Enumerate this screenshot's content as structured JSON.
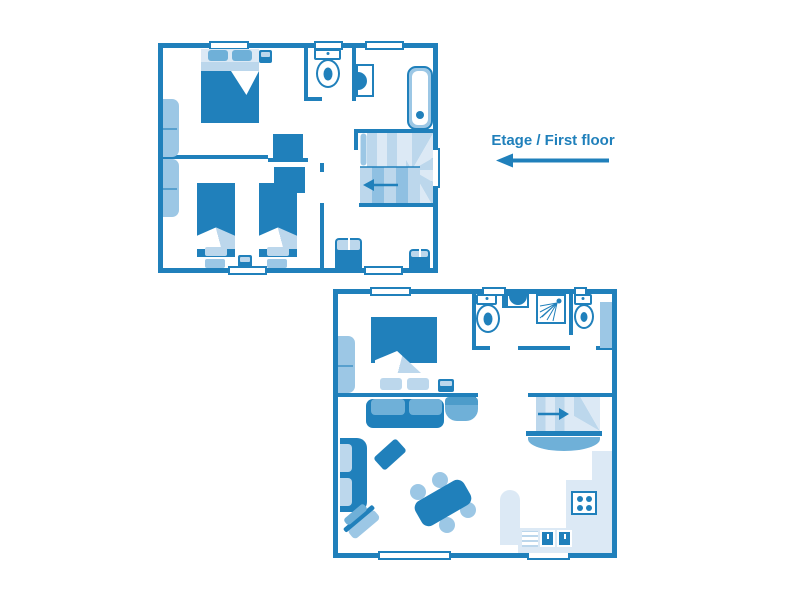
{
  "label": {
    "text": "Etage / First floor",
    "arrow_direction": "left"
  },
  "palette": {
    "primary": "#2080bb",
    "medium": "#6fb0d8",
    "light": "#9cc7e5",
    "lighter": "#bcd7ec",
    "pale": "#dce9f5"
  },
  "floors": [
    {
      "id": "first-floor",
      "rooms": [
        "double-bedroom",
        "twin-bedroom",
        "wc",
        "shower-room",
        "bathroom",
        "stair-landing"
      ],
      "furniture": [
        "double-bed",
        "wardrobe",
        "wardrobe",
        "nightstand",
        "single-bed",
        "single-bed",
        "bedside-table",
        "toilet",
        "washbasin",
        "bathtub",
        "spiral-staircase",
        "dresser",
        "dresser"
      ],
      "stairs_arrow_direction": "left"
    },
    {
      "id": "ground-floor",
      "rooms": [
        "double-bedroom",
        "bathroom",
        "living-room",
        "kitchen",
        "stair-hall"
      ],
      "furniture": [
        "double-bed",
        "wardrobe",
        "nightstand",
        "sofa",
        "side-table",
        "armchair",
        "tv-unit",
        "coffee-table",
        "dining-table",
        "chair",
        "chair",
        "chair",
        "chair",
        "toilet",
        "toilet",
        "washbasin",
        "shower",
        "radiator",
        "spiral-staircase",
        "kitchen-counter",
        "stove",
        "double-sink",
        "drainer",
        "peninsula"
      ],
      "stairs_arrow_direction": "right"
    }
  ]
}
